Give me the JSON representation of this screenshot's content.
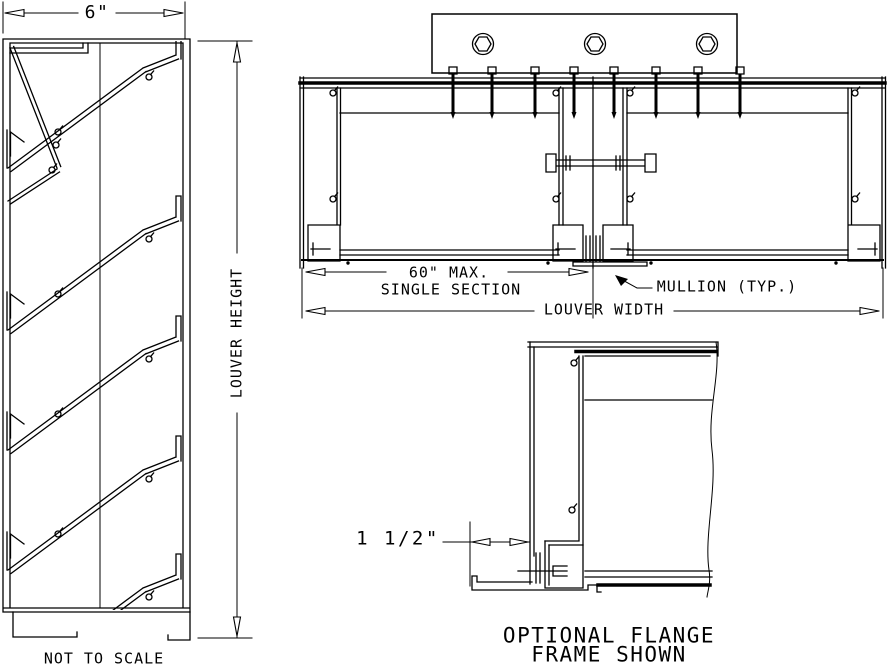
{
  "drawing": {
    "background": "#ffffff",
    "line_color": "#000000",
    "views": {
      "side_section": {
        "depth_dimension": "6\"",
        "height_dimension": "LOUVER HEIGHT",
        "scale_note": "NOT TO SCALE"
      },
      "plan_section": {
        "single_section_dim_line1": "60\" MAX.",
        "single_section_dim_line2": "SINGLE SECTION",
        "width_dimension": "LOUVER WIDTH",
        "mullion_callout": "MULLION (TYP.)"
      },
      "flange_detail": {
        "flange_dimension": "1 1/2\"",
        "caption_line1": "OPTIONAL FLANGE",
        "caption_line2": "FRAME SHOWN"
      }
    }
  }
}
